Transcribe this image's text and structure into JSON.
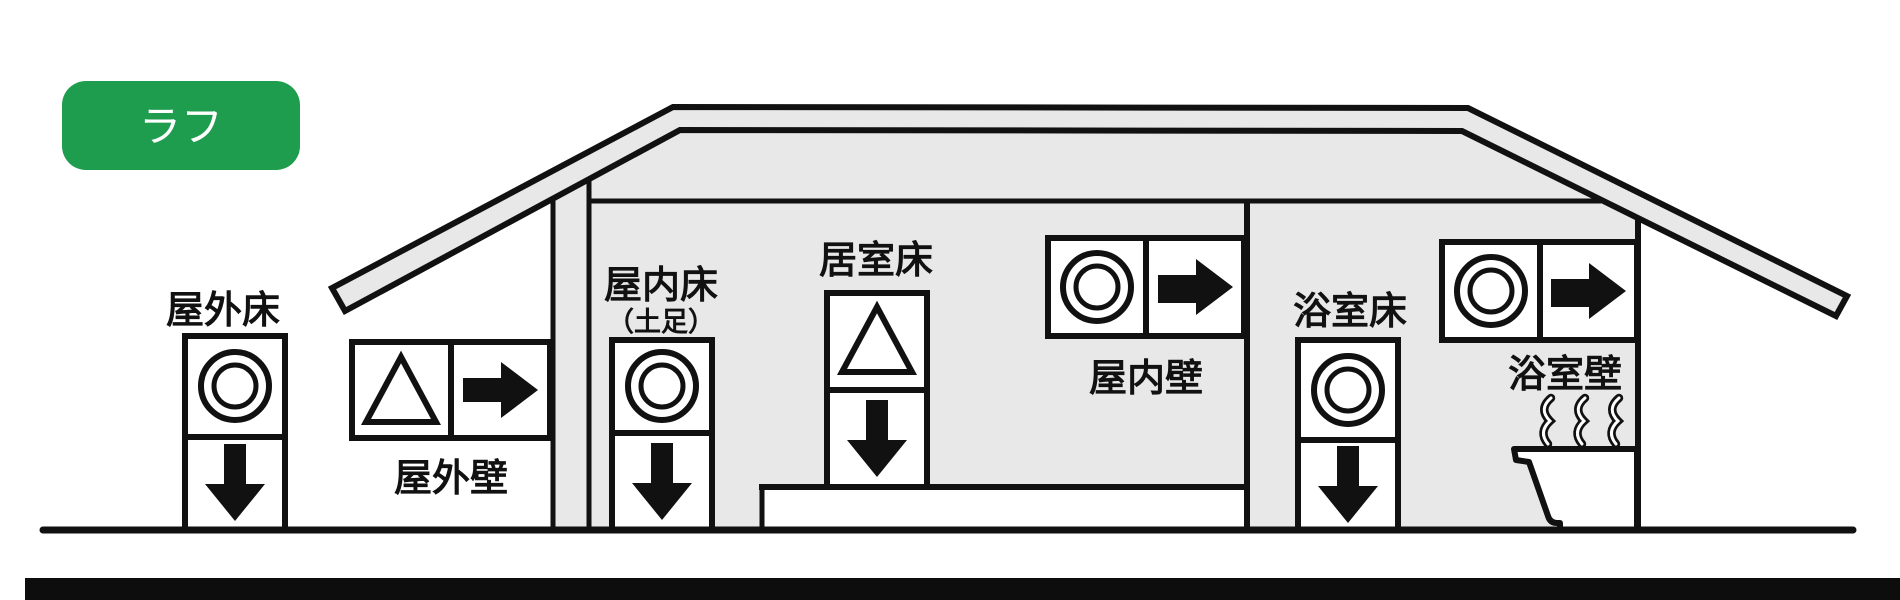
{
  "badge": {
    "label": "ラフ",
    "background": "#1f9d4e",
    "text_color": "#ffffff"
  },
  "house": {
    "fill": "#e8e8e8",
    "line_color": "#111111",
    "elements": {
      "outdoor_floor": {
        "label": "屋外床",
        "symbol": "double-circle",
        "arrow": "down"
      },
      "outdoor_wall": {
        "label": "屋外壁",
        "symbol": "triangle",
        "arrow": "right"
      },
      "indoor_floor": {
        "label": "屋内床",
        "note": "（土足）",
        "symbol": "double-circle",
        "arrow": "down"
      },
      "living_floor": {
        "label": "居室床",
        "symbol": "triangle",
        "arrow": "down"
      },
      "indoor_wall": {
        "label": "屋内壁",
        "symbol": "double-circle",
        "arrow": "right"
      },
      "bath_floor": {
        "label": "浴室床",
        "symbol": "double-circle",
        "arrow": "down"
      },
      "bath_wall": {
        "label": "浴室壁",
        "symbol": "double-circle",
        "arrow": "right",
        "extras": [
          "steam",
          "bathtub"
        ]
      }
    }
  }
}
